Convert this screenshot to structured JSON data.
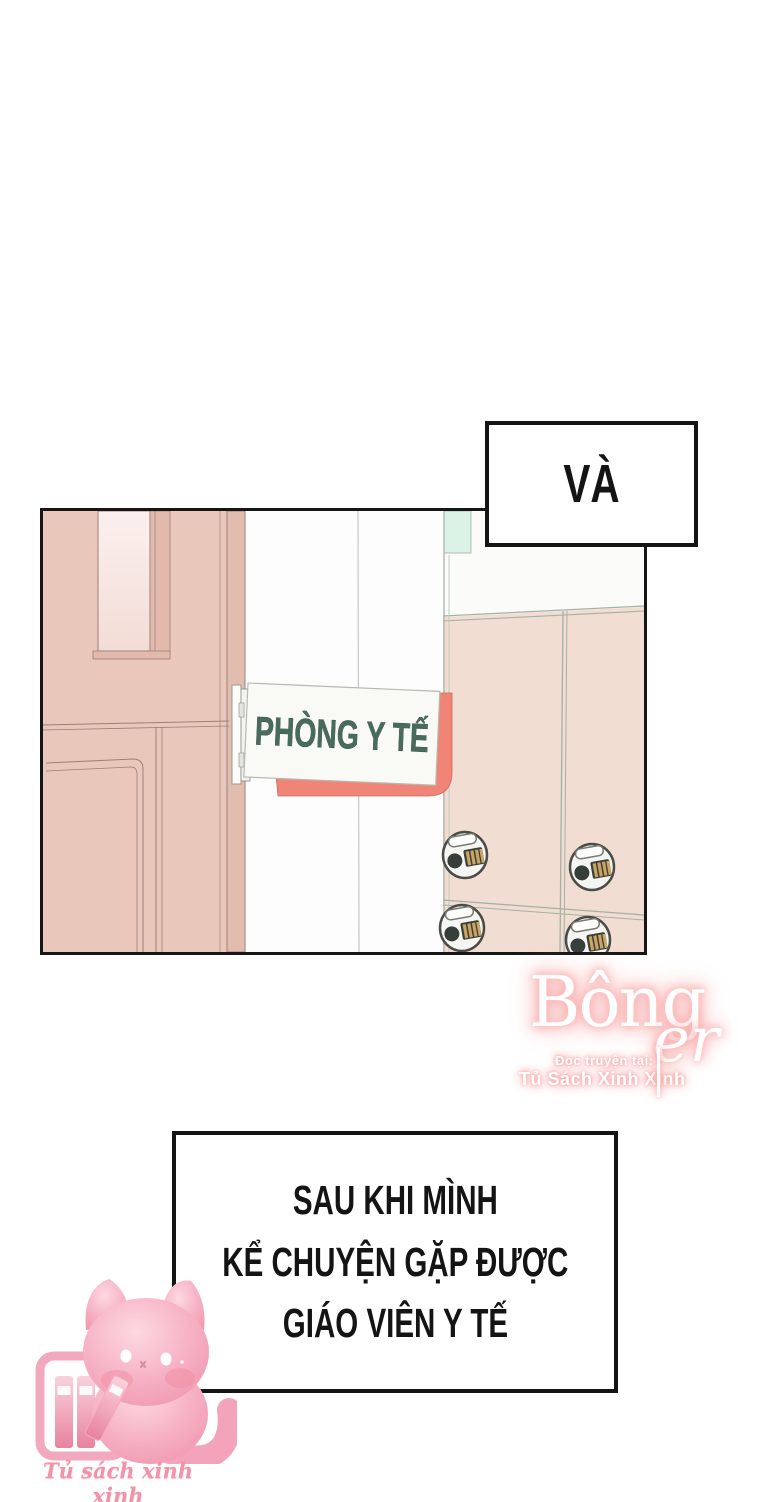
{
  "page": {
    "type": "webtoon-comic-page",
    "background": "#ffffff"
  },
  "top_caption": {
    "text": "VÀ"
  },
  "panel": {
    "sign_text": "PHÒNG Y TẾ",
    "scene": "hallway with medical-room door, hanging sign and combination-lock lockers",
    "colors": {
      "door_pink": "#eac7bb",
      "door_window_pink": "#f8e9e5",
      "wall_white": "#fdfdfd",
      "mint_accent": "#dbf2e6",
      "locker_pink": "#f2ddd2",
      "locker_line_green": "#a3b2a2",
      "sign_text_green": "#486b5e",
      "sign_backing_coral": "#f08577",
      "lock_gold": "#c9a462"
    },
    "icons": [
      "combination-lock-icon"
    ]
  },
  "watermark": {
    "brand": "Bông",
    "brand_suffix": "er",
    "tagline": "Đọc truyện tại:",
    "site": "Tủ Sách Xinh Xinh",
    "glow_color": "#f7a3a3"
  },
  "bottom_caption": {
    "lines": [
      "SAU KHI MÌNH",
      "KỂ CHUYỆN GẶP ĐƯỢC",
      "GIÁO VIÊN Y TẾ"
    ]
  },
  "footer": {
    "logo_text": "Tủ sách xinh xinh",
    "mascot": "pink cat with bookshelf",
    "mascot_pink": "#f4a8bc",
    "icons": [
      "cat-mascot-icon",
      "bookshelf-icon"
    ]
  }
}
